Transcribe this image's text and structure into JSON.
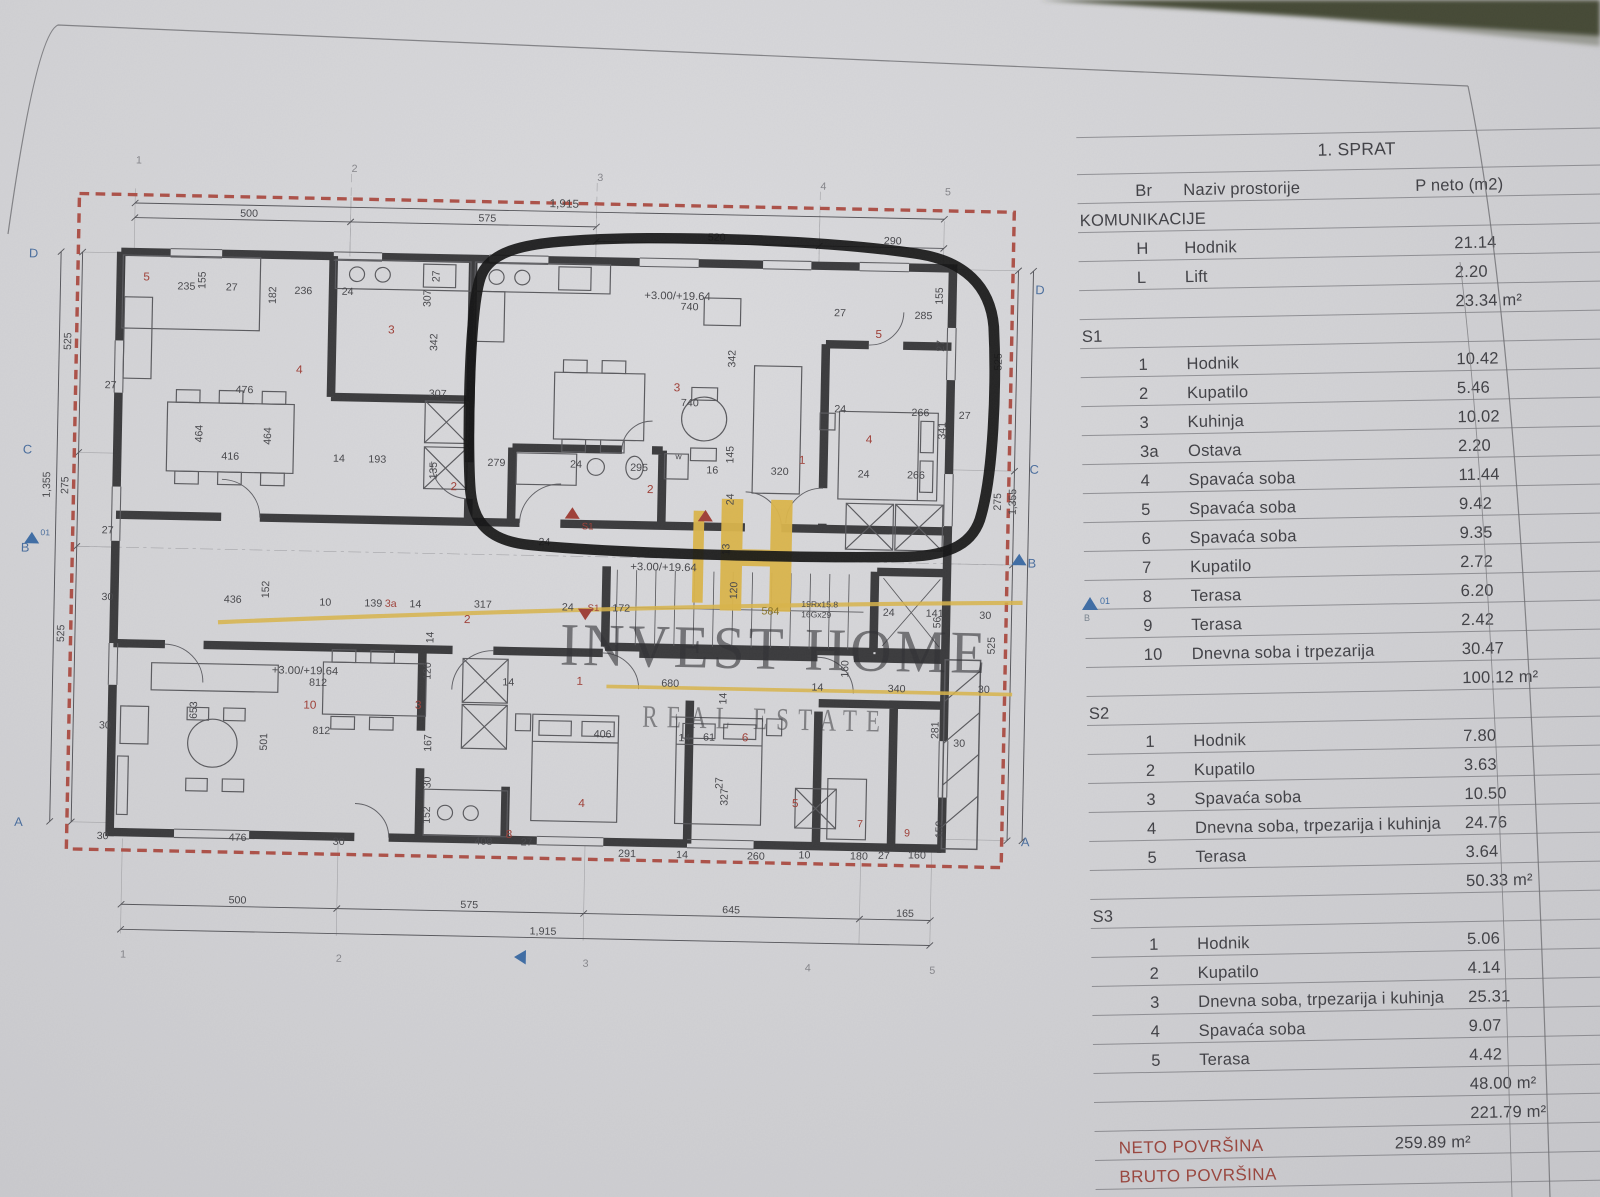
{
  "colors": {
    "red_dashed": "#ad5148",
    "wall": "#3b3b3d",
    "room_number_red": "#a04038",
    "grid_blue": "#4a6e9e",
    "logo_yellow": "#dcb64b",
    "totals_red": "#9a463e"
  },
  "page": {
    "side_marker": {
      "num": "01",
      "letter": "B"
    }
  },
  "watermark": {
    "title": "INVEST HOME",
    "subtitle": "REAL ESTATE"
  },
  "table": {
    "header": {
      "title": "1. SPRAT",
      "br": "Br",
      "name": "Naziv prostorije",
      "area": "P neto (m2)"
    },
    "rows": [
      {
        "t": "sec",
        "name": "KOMUNIKACIJE"
      },
      {
        "t": "it",
        "br": "H",
        "name": "Hodnik",
        "value": "21.14"
      },
      {
        "t": "it",
        "br": "L",
        "name": "Lift",
        "value": "2.20"
      },
      {
        "t": "sub",
        "value": "23.34 m²"
      },
      {
        "t": "sec",
        "name": "S1"
      },
      {
        "t": "it",
        "br": "1",
        "name": "Hodnik",
        "value": "10.42"
      },
      {
        "t": "it",
        "br": "2",
        "name": "Kupatilo",
        "value": "5.46"
      },
      {
        "t": "it",
        "br": "3",
        "name": "Kuhinja",
        "value": "10.02"
      },
      {
        "t": "it",
        "br": "3a",
        "name": "Ostava",
        "value": "2.20"
      },
      {
        "t": "it",
        "br": "4",
        "name": "Spavaća soba",
        "value": "11.44"
      },
      {
        "t": "it",
        "br": "5",
        "name": "Spavaća soba",
        "value": "9.42"
      },
      {
        "t": "it",
        "br": "6",
        "name": "Spavaća soba",
        "value": "9.35"
      },
      {
        "t": "it",
        "br": "7",
        "name": "Kupatilo",
        "value": "2.72"
      },
      {
        "t": "it",
        "br": "8",
        "name": "Terasa",
        "value": "6.20"
      },
      {
        "t": "it",
        "br": "9",
        "name": "Terasa",
        "value": "2.42"
      },
      {
        "t": "it",
        "br": "10",
        "name": "Dnevna soba i trpezarija",
        "value": "30.47"
      },
      {
        "t": "sub",
        "value": "100.12 m²"
      },
      {
        "t": "sec",
        "name": "S2"
      },
      {
        "t": "it",
        "br": "1",
        "name": "Hodnik",
        "value": "7.80"
      },
      {
        "t": "it",
        "br": "2",
        "name": "Kupatilo",
        "value": "3.63"
      },
      {
        "t": "it",
        "br": "3",
        "name": "Spavaća soba",
        "value": "10.50"
      },
      {
        "t": "it",
        "br": "4",
        "name": "Dnevna soba, trpezarija i kuhinja",
        "value": "24.76"
      },
      {
        "t": "it",
        "br": "5",
        "name": "Terasa",
        "value": "3.64"
      },
      {
        "t": "sub",
        "value": "50.33 m²"
      },
      {
        "t": "sec",
        "name": "S3"
      },
      {
        "t": "it",
        "br": "1",
        "name": "Hodnik",
        "value": "5.06"
      },
      {
        "t": "it",
        "br": "2",
        "name": "Kupatilo",
        "value": "4.14"
      },
      {
        "t": "it",
        "br": "3",
        "name": "Dnevna soba, trpezarija i kuhinja",
        "value": "25.31"
      },
      {
        "t": "it",
        "br": "4",
        "name": "Spavaća soba",
        "value": "9.07"
      },
      {
        "t": "it",
        "br": "5",
        "name": "Terasa",
        "value": "4.42"
      },
      {
        "t": "sub",
        "value": "48.00 m²"
      },
      {
        "t": "sub2",
        "value": "221.79 m²"
      },
      {
        "t": "tot",
        "name": "NETO POVRŠINA",
        "value": "259.89 m²"
      },
      {
        "t": "tot",
        "name": "BRUTO POVRŠINA",
        "value": ""
      }
    ]
  },
  "plan": {
    "labels": [
      {
        "t": "1",
        "x": 114,
        "y": 20,
        "c": "g"
      },
      {
        "t": "2",
        "x": 315,
        "y": 24,
        "c": "g"
      },
      {
        "t": "3",
        "x": 544,
        "y": 28,
        "c": "g"
      },
      {
        "t": "4",
        "x": 752,
        "y": 32,
        "c": "g"
      },
      {
        "t": "5",
        "x": 868,
        "y": 35,
        "c": "g"
      },
      {
        "t": "1,915",
        "x": 500,
        "y": 54,
        "s": 11
      },
      {
        "t": "500",
        "x": 212,
        "y": 69
      },
      {
        "t": "575",
        "x": 434,
        "y": 69
      },
      {
        "t": "520",
        "x": 648,
        "y": 83
      },
      {
        "t": "290",
        "x": 812,
        "y": 83
      },
      {
        "t": "500",
        "x": 214,
        "y": 727
      },
      {
        "t": "575",
        "x": 430,
        "y": 727
      },
      {
        "t": "645",
        "x": 674,
        "y": 727
      },
      {
        "t": "165",
        "x": 836,
        "y": 727
      },
      {
        "t": "1,915",
        "x": 495,
        "y": 751
      },
      {
        "t": "1",
        "x": 114,
        "y": 781,
        "c": "g"
      },
      {
        "t": "2",
        "x": 315,
        "y": 781,
        "c": "g"
      },
      {
        "t": "3",
        "x": 545,
        "y": 781,
        "c": "g"
      },
      {
        "t": "4",
        "x": 752,
        "y": 781,
        "c": "g"
      },
      {
        "t": "5",
        "x": 868,
        "y": 781,
        "c": "g"
      },
      {
        "t": "D",
        "x": 16,
        "y": 112,
        "s": 12,
        "c": "b"
      },
      {
        "t": "C",
        "x": 14,
        "y": 300,
        "s": 12,
        "c": "b"
      },
      {
        "t": "B",
        "x": 14,
        "y": 394,
        "s": 12,
        "c": "b"
      },
      {
        "t": "A",
        "x": 13,
        "y": 657,
        "s": 12,
        "c": "b"
      },
      {
        "t": "01",
        "x": 32,
        "y": 378,
        "s": 8,
        "c": "b"
      },
      {
        "t": "525",
        "x": 57,
        "y": 200,
        "r": -90
      },
      {
        "t": "275",
        "x": 57,
        "y": 338,
        "r": -90
      },
      {
        "t": "1,355",
        "x": 40,
        "y": 342,
        "r": -90
      },
      {
        "t": "525",
        "x": 56,
        "y": 480,
        "r": -90
      },
      {
        "t": "D",
        "x": 954,
        "y": 128,
        "s": 12,
        "c": "b"
      },
      {
        "t": "C",
        "x": 952,
        "y": 300,
        "s": 12,
        "c": "b"
      },
      {
        "t": "B",
        "x": 952,
        "y": 390,
        "s": 12,
        "c": "b"
      },
      {
        "t": "A",
        "x": 951,
        "y": 657,
        "s": 12,
        "c": "b"
      },
      {
        "t": "525",
        "x": 924,
        "y": 202,
        "r": -90
      },
      {
        "t": "275",
        "x": 926,
        "y": 336,
        "r": -90
      },
      {
        "t": "1,355",
        "x": 940,
        "y": 340,
        "r": -90
      },
      {
        "t": "525",
        "x": 923,
        "y": 474,
        "r": -90
      },
      {
        "t": "27",
        "x": 89,
        "y": 236
      },
      {
        "t": "27",
        "x": 89,
        "y": 375
      },
      {
        "t": "30",
        "x": 90,
        "y": 439
      },
      {
        "t": "30",
        "x": 90,
        "y": 562
      },
      {
        "t": "30",
        "x": 90,
        "y": 668
      },
      {
        "t": "5",
        "x": 123,
        "y": 132,
        "s": 11,
        "c": "r"
      },
      {
        "t": "235",
        "x": 155,
        "y": 140
      },
      {
        "t": "155",
        "x": 181,
        "y": 139,
        "r": -90
      },
      {
        "t": "27",
        "x": 200,
        "y": 140
      },
      {
        "t": "236",
        "x": 264,
        "y": 142
      },
      {
        "t": "24",
        "x": 308,
        "y": 142
      },
      {
        "t": "307",
        "x": 391,
        "y": 152,
        "r": -90
      },
      {
        "t": "27",
        "x": 399,
        "y": 128,
        "r": -90
      },
      {
        "t": "182",
        "x": 247,
        "y": 152,
        "r": -90
      },
      {
        "t": "342",
        "x": 398,
        "y": 194,
        "r": -90
      },
      {
        "t": "3",
        "x": 352,
        "y": 178,
        "s": 11,
        "c": "r"
      },
      {
        "t": "4",
        "x": 267,
        "y": 218,
        "s": 11,
        "c": "r"
      },
      {
        "t": "476",
        "x": 211,
        "y": 238
      },
      {
        "t": "307",
        "x": 391,
        "y": 238
      },
      {
        "t": "464",
        "x": 181,
        "y": 286,
        "r": -90
      },
      {
        "t": "416",
        "x": 199,
        "y": 302
      },
      {
        "t": "464",
        "x": 245,
        "y": 287,
        "r": -90
      },
      {
        "t": "14",
        "x": 303,
        "y": 302
      },
      {
        "t": "193",
        "x": 336,
        "y": 302
      },
      {
        "t": "135",
        "x": 400,
        "y": 317,
        "r": -90
      },
      {
        "t": "279",
        "x": 447,
        "y": 303
      },
      {
        "t": "2",
        "x": 413,
        "y": 327,
        "s": 11,
        "c": "r"
      },
      {
        "t": "+3.00/+19.64",
        "x": 590,
        "y": 140,
        "s": 10.5
      },
      {
        "t": "740",
        "x": 624,
        "y": 150
      },
      {
        "t": "342",
        "x": 676,
        "y": 204,
        "r": -90
      },
      {
        "t": "3",
        "x": 619,
        "y": 228,
        "s": 11,
        "c": "r"
      },
      {
        "t": "740",
        "x": 626,
        "y": 242
      },
      {
        "t": "27",
        "x": 767,
        "y": 153
      },
      {
        "t": "285",
        "x": 842,
        "y": 154
      },
      {
        "t": "155",
        "x": 868,
        "y": 140,
        "r": -90
      },
      {
        "t": "5",
        "x": 806,
        "y": 173,
        "s": 11,
        "c": "r"
      },
      {
        "t": "27",
        "x": 870,
        "y": 185,
        "r": -90
      },
      {
        "t": "266",
        "x": 841,
        "y": 247
      },
      {
        "t": "27",
        "x": 885,
        "y": 249
      },
      {
        "t": "341",
        "x": 873,
        "y": 269,
        "r": -90
      },
      {
        "t": "4",
        "x": 799,
        "y": 274,
        "s": 11,
        "c": "r"
      },
      {
        "t": "24",
        "x": 769,
        "y": 245
      },
      {
        "t": "1",
        "x": 737,
        "y": 295,
        "s": 11,
        "c": "r"
      },
      {
        "t": "320",
        "x": 711,
        "y": 306
      },
      {
        "t": "24",
        "x": 792,
        "y": 307
      },
      {
        "t": "266",
        "x": 838,
        "y": 307
      },
      {
        "t": "16",
        "x": 651,
        "y": 306
      },
      {
        "t": "145",
        "x": 676,
        "y": 296,
        "r": -90
      },
      {
        "t": "295",
        "x": 580,
        "y": 305
      },
      {
        "t": "w",
        "x": 622,
        "y": 293,
        "s": 8
      },
      {
        "t": "24",
        "x": 524,
        "y": 303
      },
      {
        "t": "2",
        "x": 596,
        "y": 326,
        "s": 11,
        "c": "r"
      },
      {
        "t": "24",
        "x": 677,
        "y": 336,
        "r": -90
      },
      {
        "t": "24",
        "x": 496,
        "y": 378
      },
      {
        "t": "13",
        "x": 674,
        "y": 384,
        "r": -90
      },
      {
        "t": "S1",
        "x": 536,
        "y": 362,
        "s": 9,
        "c": "r"
      },
      {
        "t": "24",
        "x": 519,
        "y": 440
      },
      {
        "t": "S1",
        "x": 543,
        "y": 440,
        "s": 9,
        "c": "r"
      },
      {
        "t": "172",
        "x": 566,
        "y": 440
      },
      {
        "t": "+3.00/+19.64",
        "x": 582,
        "y": 400,
        "s": 10.5
      },
      {
        "t": "120",
        "x": 682,
        "y": 426,
        "r": -90
      },
      {
        "t": "584",
        "x": 705,
        "y": 440,
        "c": "y"
      },
      {
        "t": "19Rx15.8",
        "x": 742,
        "y": 432,
        "s": 8
      },
      {
        "t": "16Gx29",
        "x": 742,
        "y": 442,
        "s": 8
      },
      {
        "t": "24",
        "x": 818,
        "y": 439
      },
      {
        "t": "141",
        "x": 858,
        "y": 439
      },
      {
        "t": "56",
        "x": 872,
        "y": 450,
        "r": -90
      },
      {
        "t": "30",
        "x": 908,
        "y": 440
      },
      {
        "t": "1",
        "x": 534,
        "y": 511,
        "s": 11,
        "c": "r"
      },
      {
        "t": "680",
        "x": 613,
        "y": 511
      },
      {
        "t": "160",
        "x": 787,
        "y": 499,
        "r": -90
      },
      {
        "t": "14",
        "x": 753,
        "y": 512
      },
      {
        "t": "340",
        "x": 824,
        "y": 512
      },
      {
        "t": "30",
        "x": 908,
        "y": 511
      },
      {
        "t": "14",
        "x": 674,
        "y": 527,
        "r": -90
      },
      {
        "t": "436",
        "x": 204,
        "y": 439
      },
      {
        "t": "152",
        "x": 246,
        "y": 434,
        "r": -90
      },
      {
        "t": "10",
        "x": 293,
        "y": 440
      },
      {
        "t": "139",
        "x": 335,
        "y": 440
      },
      {
        "t": "3a",
        "x": 354,
        "y": 440,
        "s": 10,
        "c": "r"
      },
      {
        "t": "14",
        "x": 377,
        "y": 440
      },
      {
        "t": "317",
        "x": 437,
        "y": 439
      },
      {
        "t": "2",
        "x": 428,
        "y": 454,
        "s": 11,
        "c": "r"
      },
      {
        "t": "14",
        "x": 400,
        "y": 474,
        "r": -90
      },
      {
        "t": "+3.00/+19.64",
        "x": 250,
        "y": 506,
        "s": 10.5
      },
      {
        "t": "812",
        "x": 285,
        "y": 517
      },
      {
        "t": "10",
        "x": 280,
        "y": 539,
        "s": 11,
        "c": "r"
      },
      {
        "t": "3",
        "x": 384,
        "y": 537,
        "s": 11,
        "c": "r"
      },
      {
        "t": "653",
        "x": 181,
        "y": 551,
        "r": -90
      },
      {
        "t": "812",
        "x": 289,
        "y": 563
      },
      {
        "t": "501",
        "x": 247,
        "y": 580,
        "r": -90
      },
      {
        "t": "120",
        "x": 398,
        "y": 509,
        "r": -90
      },
      {
        "t": "14",
        "x": 465,
        "y": 513
      },
      {
        "t": "167",
        "x": 400,
        "y": 578,
        "r": -90
      },
      {
        "t": "30",
        "x": 400,
        "y": 613,
        "r": -90
      },
      {
        "t": "476",
        "x": 213,
        "y": 667
      },
      {
        "t": "30",
        "x": 310,
        "y": 669
      },
      {
        "t": "406",
        "x": 551,
        "y": 561
      },
      {
        "t": "14",
        "x": 630,
        "y": 563
      },
      {
        "t": "61",
        "x": 653,
        "y": 562
      },
      {
        "t": "6",
        "x": 689,
        "y": 562,
        "s": 11,
        "c": "r"
      },
      {
        "t": "281",
        "x": 872,
        "y": 556,
        "r": -90
      },
      {
        "t": "30",
        "x": 886,
        "y": 563
      },
      {
        "t": "327",
        "x": 677,
        "y": 624,
        "r": -90
      },
      {
        "t": "4",
        "x": 538,
        "y": 628,
        "s": 11,
        "c": "r"
      },
      {
        "t": "5",
        "x": 737,
        "y": 624,
        "s": 11,
        "c": "r"
      },
      {
        "t": "7",
        "x": 798,
        "y": 642,
        "s": 10,
        "c": "r"
      },
      {
        "t": "9",
        "x": 842,
        "y": 650,
        "s": 10,
        "c": "r"
      },
      {
        "t": "8",
        "x": 471,
        "y": 659,
        "s": 11,
        "c": "r"
      },
      {
        "t": "291",
        "x": 576,
        "y": 675
      },
      {
        "t": "14",
        "x": 630,
        "y": 675
      },
      {
        "t": "260",
        "x": 696,
        "y": 675
      },
      {
        "t": "10",
        "x": 744,
        "y": 673
      },
      {
        "t": "180",
        "x": 792,
        "y": 673
      },
      {
        "t": "27",
        "x": 818,
        "y": 672
      },
      {
        "t": "160",
        "x": 846,
        "y": 671
      },
      {
        "t": "152",
        "x": 878,
        "y": 651,
        "r": -90
      },
      {
        "t": "408",
        "x": 442,
        "y": 666
      },
      {
        "t": "27",
        "x": 485,
        "y": 666
      },
      {
        "t": "152",
        "x": 400,
        "y": 647,
        "r": -90
      },
      {
        "t": "27",
        "x": 672,
        "y": 608,
        "r": -90
      }
    ],
    "markers": [
      {
        "x": 527,
        "y": 352,
        "d": "up",
        "c": "red"
      },
      {
        "x": 651,
        "y": 352,
        "d": "up",
        "c": "red"
      },
      {
        "x": 541,
        "y": 449,
        "d": "down",
        "c": "red"
      },
      {
        "x": 24,
        "y": 386,
        "d": "up",
        "c": "blue"
      },
      {
        "x": 944,
        "y": 388,
        "d": "up",
        "c": "blue"
      },
      {
        "x": 492,
        "y": 773,
        "d": "left",
        "c": "blue"
      }
    ]
  }
}
